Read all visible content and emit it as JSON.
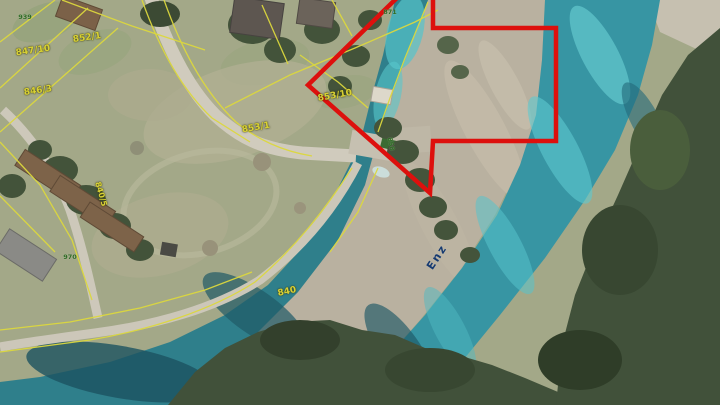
{
  "view": {
    "type": "aerial-cadastral-map",
    "description": "Aerial orthophoto with cadastral parcel overlay, river Enz, and red selection arrow annotation"
  },
  "map": {
    "water_name": "Enz",
    "parcels": {
      "p852_1": "852/1",
      "p847_10": "847/10",
      "p846_3": "846/3",
      "p853_1": "853/1",
      "p853_10": "853/10",
      "p840_5": "840/5",
      "p840": "840",
      "p858": "858"
    },
    "house_numbers": {
      "top_left": "939",
      "bottom_left": "970",
      "top_center": "871"
    }
  },
  "colors": {
    "annotation_red": "#dd100d",
    "parcel_line": "#dcd83e",
    "parcel_label": "#d8d134",
    "house_label": "#2f6b25",
    "water_label": "#173a70",
    "water": "#3795a3",
    "water_bright": "#5ec9d0",
    "water_dark": "#1d5765",
    "meadow": "#a3a888",
    "island": "#b9b1a0",
    "tree": "#41513a",
    "road": "#d0cbbd"
  }
}
